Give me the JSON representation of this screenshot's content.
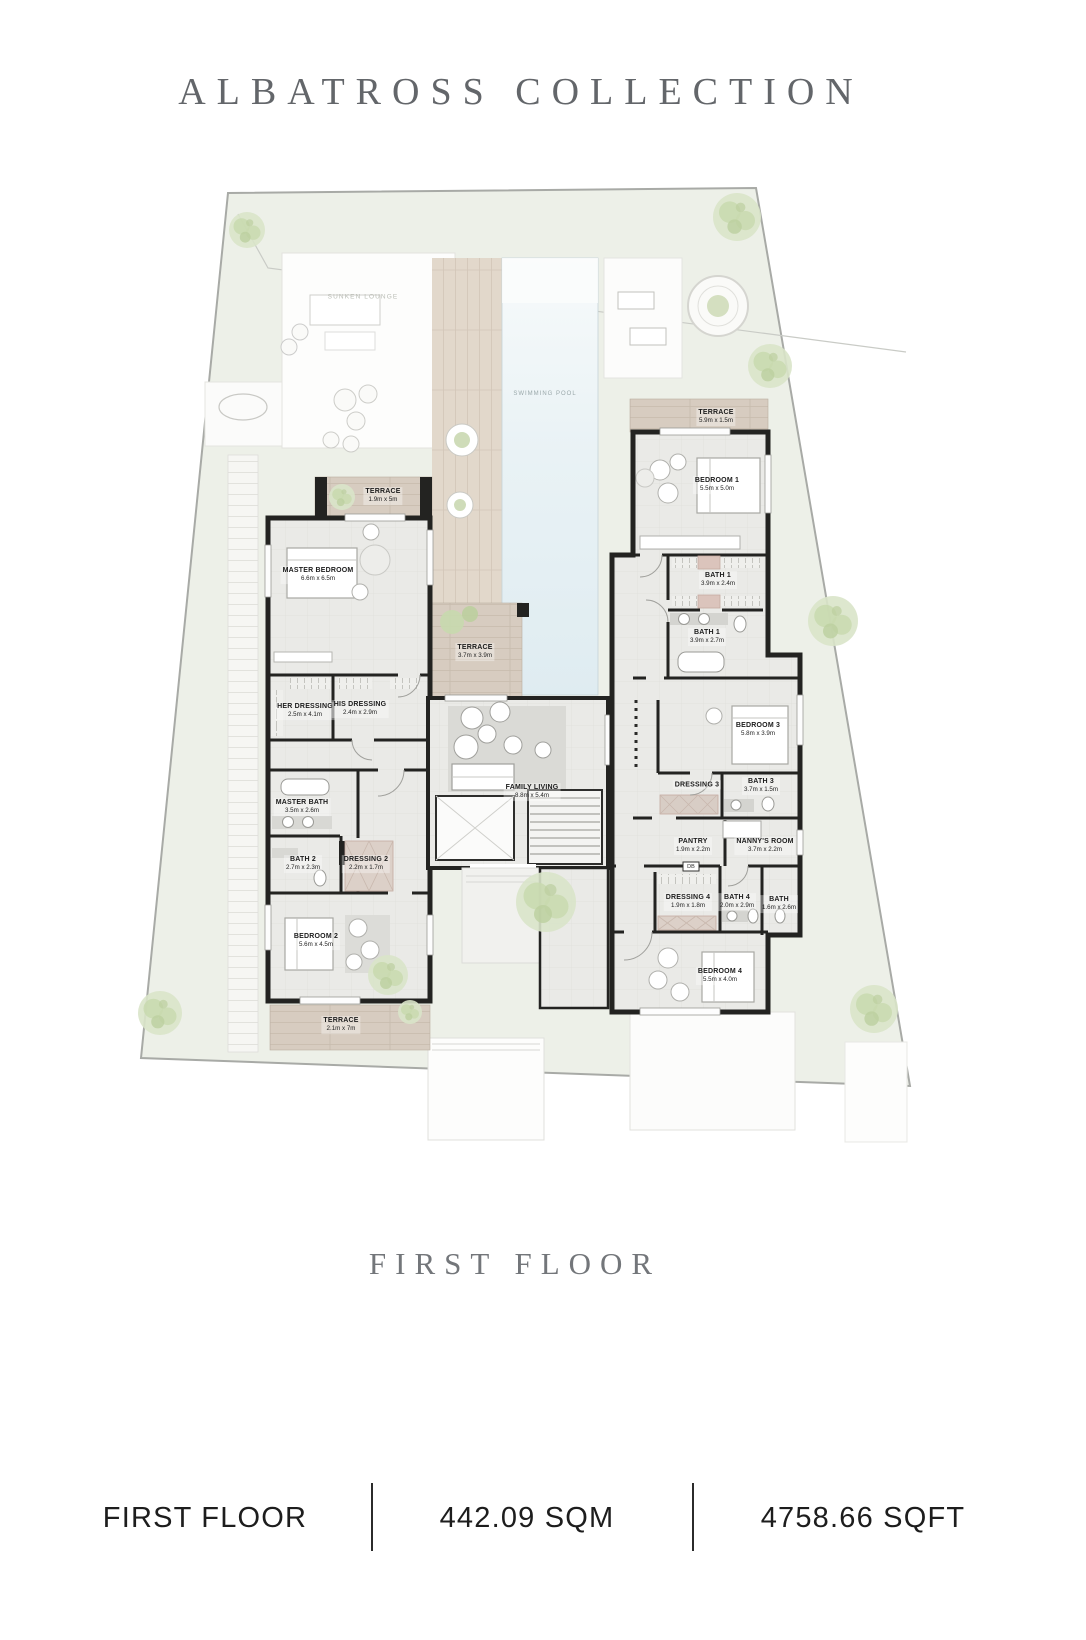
{
  "title": "ALBATROSS COLLECTION",
  "floor_heading": "FIRST FLOOR",
  "footer": {
    "floor_label": "FIRST FLOOR",
    "area_sqm": "442.09 SQM",
    "area_sqft": "4758.66 SQFT"
  },
  "plan": {
    "pool_label": "SWIMMING POOL",
    "sunken_lounge_label": "SUNKEN LOUNGE",
    "db_label": "DB",
    "rooms": [
      {
        "id": "terrace-left-top",
        "name": "TERRACE",
        "dims": "1.9m x 5m"
      },
      {
        "id": "master-bedroom",
        "name": "MASTER BEDROOM",
        "dims": "6.6m x 6.5m"
      },
      {
        "id": "her-dressing",
        "name": "HER DRESSING",
        "dims": "2.5m x 4.1m"
      },
      {
        "id": "his-dressing",
        "name": "HIS DRESSING",
        "dims": "2.4m x 2.9m"
      },
      {
        "id": "master-bath",
        "name": "MASTER BATH",
        "dims": "3.5m x 2.6m"
      },
      {
        "id": "bath-2",
        "name": "BATH 2",
        "dims": "2.7m x 2.3m"
      },
      {
        "id": "dressing-2",
        "name": "DRESSING 2",
        "dims": "2.2m x 1.7m"
      },
      {
        "id": "bedroom-2",
        "name": "BEDROOM 2",
        "dims": "5.6m x 4.5m"
      },
      {
        "id": "terrace-left-bottom",
        "name": "TERRACE",
        "dims": "2.1m x 7m"
      },
      {
        "id": "terrace-center",
        "name": "TERRACE",
        "dims": "3.7m x 3.9m"
      },
      {
        "id": "family-living",
        "name": "FAMILY LIVING",
        "dims": "8.8m x 5.4m"
      },
      {
        "id": "terrace-right-top",
        "name": "TERRACE",
        "dims": "5.9m x 1.5m"
      },
      {
        "id": "bedroom-1",
        "name": "BEDROOM 1",
        "dims": "5.5m x 5.0m"
      },
      {
        "id": "bath-1-upper",
        "name": "BATH 1",
        "dims": "3.9m x 2.4m"
      },
      {
        "id": "bath-1-lower",
        "name": "BATH 1",
        "dims": "3.9m x 2.7m"
      },
      {
        "id": "bedroom-3",
        "name": "BEDROOM 3",
        "dims": "5.8m x 3.9m"
      },
      {
        "id": "dressing-3",
        "name": "DRESSING 3",
        "dims": ""
      },
      {
        "id": "bath-3",
        "name": "BATH 3",
        "dims": "3.7m x 1.5m"
      },
      {
        "id": "pantry",
        "name": "PANTRY",
        "dims": "1.9m x 2.2m"
      },
      {
        "id": "nannys-room",
        "name": "NANNY'S ROOM",
        "dims": "3.7m x 2.2m"
      },
      {
        "id": "dressing-4",
        "name": "DRESSING 4",
        "dims": "1.9m x 1.8m"
      },
      {
        "id": "bath-4",
        "name": "BATH 4",
        "dims": "2.0m x 2.9m"
      },
      {
        "id": "bath-5",
        "name": "BATH",
        "dims": "1.6m x 2.6m"
      },
      {
        "id": "bedroom-4",
        "name": "BEDROOM 4",
        "dims": "5.5m x 4.0m"
      }
    ],
    "colors": {
      "plot_green": "#edf0e8",
      "pool_blue": "#e7f1f5",
      "terrace_wood": "#d7ccc0",
      "wall_dark": "#232321",
      "floor_gray": "#eaeae7",
      "heading_gray": "#63666a"
    }
  }
}
